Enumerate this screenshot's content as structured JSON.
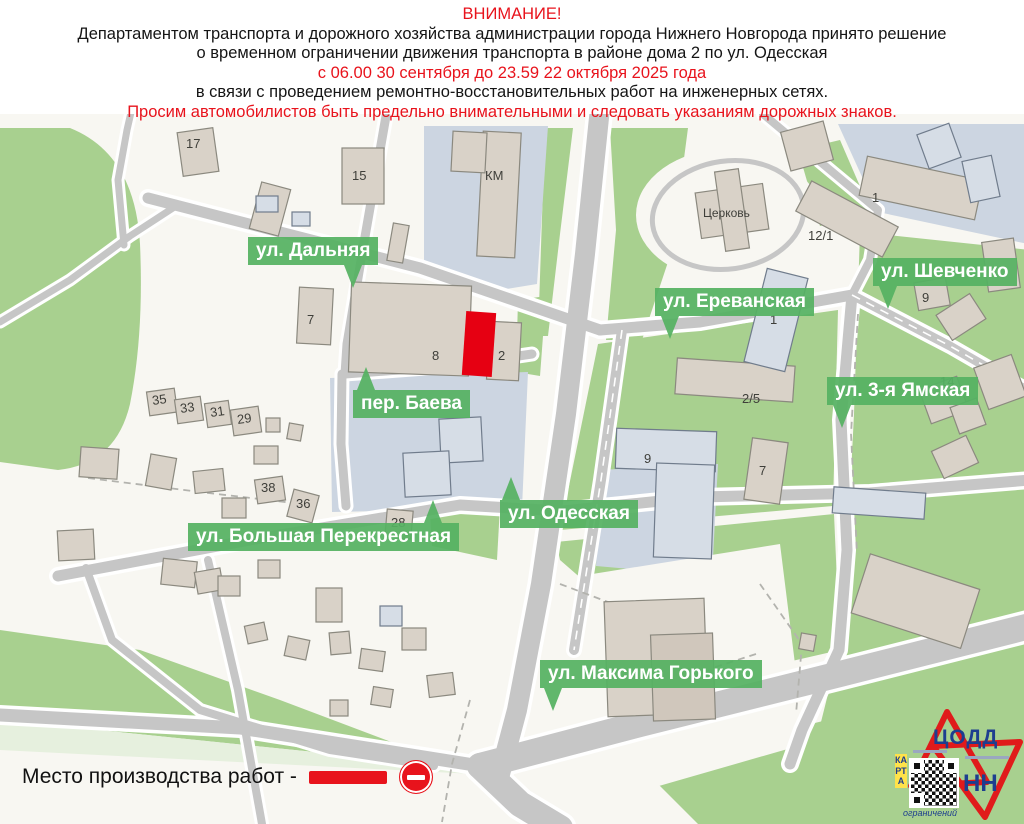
{
  "header": {
    "line1": "ВНИМАНИЕ!",
    "line2": "Департаментом транспорта и дорожного хозяйства администрации города Нижнего Новгорода принято решение",
    "line3": "о временном ограничении движения транспорта в районе дома 2 по ул. Одесская",
    "line4": "с 06.00 30 сентября до 23.59 22 октября 2025 года",
    "line5": "в связи с проведением ремонтно-восстановительных работ на инженерных сетях.",
    "line6": "Просим автомобилистов быть предельно внимательными и следовать указаниям дорожных знаков."
  },
  "map": {
    "streets": [
      {
        "name": "ул. Дальняя"
      },
      {
        "name": "ул. Ереванская"
      },
      {
        "name": "ул. Шевченко"
      },
      {
        "name": "ул. 3-я Ямская"
      },
      {
        "name": "пер. Баева"
      },
      {
        "name": "ул. Большая Перекрестная"
      },
      {
        "name": "ул. Одесская"
      },
      {
        "name": "ул. Максима Горького"
      }
    ],
    "buildings": [
      {
        "label": "17"
      },
      {
        "label": "15"
      },
      {
        "label": "КМ"
      },
      {
        "label": "7"
      },
      {
        "label": "8"
      },
      {
        "label": "2"
      },
      {
        "label": "35"
      },
      {
        "label": "33"
      },
      {
        "label": "31"
      },
      {
        "label": "29"
      },
      {
        "label": "38"
      },
      {
        "label": "36"
      },
      {
        "label": "28"
      },
      {
        "label": "Церковь"
      },
      {
        "label": "1"
      },
      {
        "label": "12/1"
      },
      {
        "label": "9"
      },
      {
        "label": "2/5"
      },
      {
        "label": "9"
      },
      {
        "label": "7"
      },
      {
        "label": "14"
      },
      {
        "label": "1"
      }
    ],
    "colors": {
      "accent_red": "#e8131c",
      "work_site_red": "#e60012",
      "street_label_green": "#55b262",
      "park_green": "#a8d08f",
      "road_gray": "#c6c6c6"
    }
  },
  "legend": {
    "text": "Место производства работ -"
  },
  "logo": {
    "org": "ЦОДД",
    "city": "НН",
    "karta": "КАРТА",
    "restrictions": "ограничений"
  }
}
